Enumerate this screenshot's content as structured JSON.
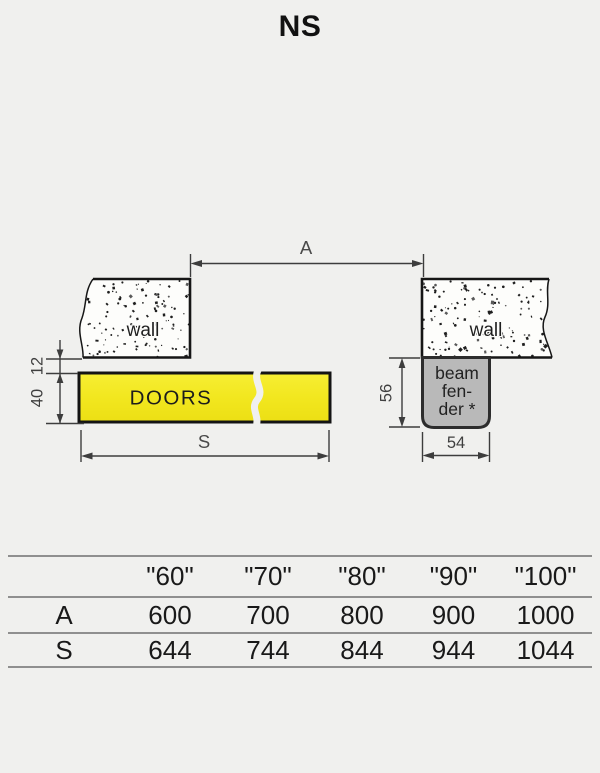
{
  "title": "NS",
  "diagram": {
    "dim_a_label": "A",
    "dim_s_label": "S",
    "left_wall_label": "wall",
    "right_wall_label": "wall",
    "doors_label": "DOORS",
    "dim_12": "12",
    "dim_40": "40",
    "dim_56": "56",
    "dim_54": "54",
    "beam_fender_line1": "beam",
    "beam_fender_line2": "fen-",
    "beam_fender_line3": "der *",
    "colors": {
      "background": "#f0f0ee",
      "doors_fill": "#f2e71f",
      "fender_fill": "#b9b9b9",
      "wall_fill": "#fdfdfb",
      "drawing_line": "#161616",
      "dimension_line": "#3d3d3d",
      "table_line": "#8f8f8f"
    }
  },
  "table": {
    "headers": [
      "",
      "\"60\"",
      "\"70\"",
      "\"80\"",
      "\"90\"",
      "\"100\""
    ],
    "rows": [
      {
        "label": "A",
        "values": [
          "600",
          "700",
          "800",
          "900",
          "1000"
        ]
      },
      {
        "label": "S",
        "values": [
          "644",
          "744",
          "844",
          "944",
          "1044"
        ]
      }
    ]
  }
}
